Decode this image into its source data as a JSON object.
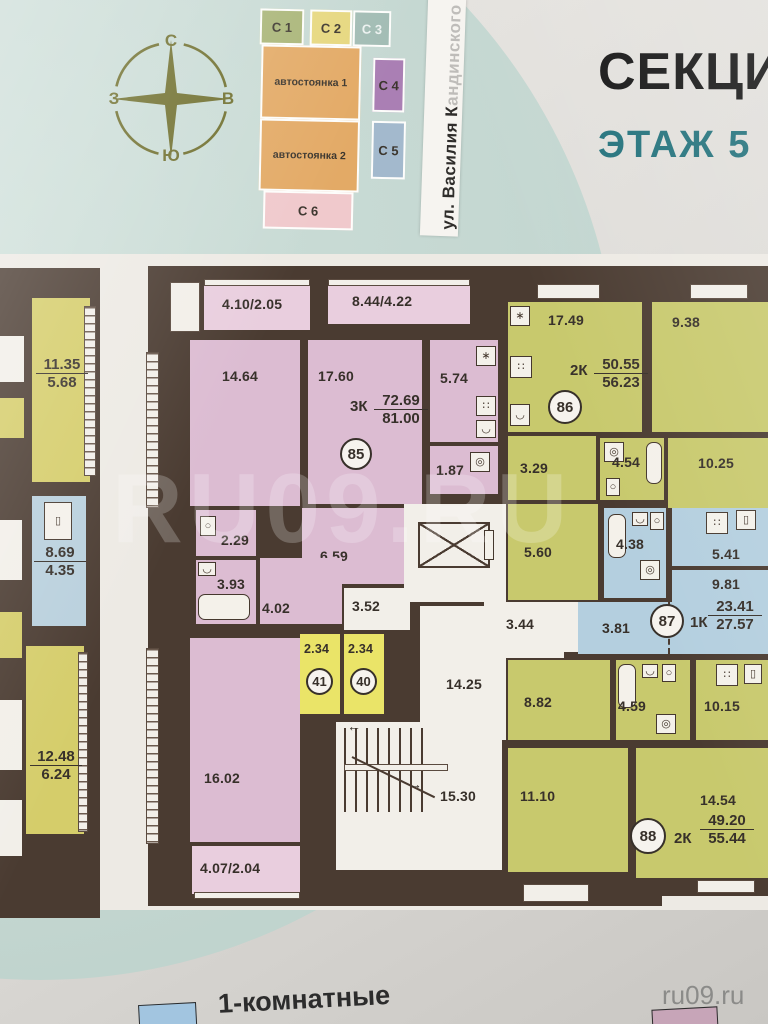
{
  "header": {
    "title": "СЕКЦИЯ",
    "floor_label": "ЭТАЖ 5"
  },
  "street": {
    "visible": "ул. Василия К",
    "faded": "андинского"
  },
  "compass": {
    "n": "С",
    "e": "В",
    "s": "Ю",
    "w": "З"
  },
  "site_map": {
    "c1": "С 1",
    "c2": "С 2",
    "c3": "С 3",
    "c4": "С 4",
    "c5": "С 5",
    "c6": "С 6",
    "parking1": "автостоянка 1",
    "parking2": "автостоянка 2"
  },
  "apartments": {
    "a85": {
      "no": "85",
      "type": "3К",
      "living": "72.69",
      "total": "81.00",
      "balcony_left": "4.10/2.05",
      "balcony_right": "8.44/4.22",
      "balcony_bottom": "4.07/2.04",
      "room1": "14.64",
      "room2": "17.60",
      "kitchen": "5.74",
      "bath_wc": "1.87",
      "wc": "2.29",
      "bath": "3.93",
      "hall": "4.02",
      "corridor": "6.59",
      "room3": "16.02"
    },
    "a86": {
      "no": "86",
      "type": "2К",
      "living": "50.55",
      "total": "56.23",
      "room1": "17.49",
      "room2": "9.38",
      "hall": "3.29",
      "bath": "4.54",
      "kitchen": "10.25",
      "hall2": "5.60"
    },
    "a87": {
      "no": "87",
      "type": "1К",
      "living": "23.41",
      "total": "27.57",
      "bath": "4.38",
      "kitchen": "5.41",
      "room": "9.81",
      "hall": "3.81"
    },
    "a88": {
      "no": "88",
      "type": "2К",
      "living": "49.20",
      "total": "55.44",
      "hall": "8.82",
      "bath": "4.59",
      "kitchen": "10.15",
      "room1": "11.10",
      "room2": "14.54"
    }
  },
  "storage": {
    "s41_no": "41",
    "s41_area": "2.34",
    "s40_no": "40",
    "s40_area": "2.34"
  },
  "common": {
    "hall_small": "3.52",
    "corridor": "14.25",
    "hall": "3.44",
    "stairs": "15.30"
  },
  "adjacent": {
    "apt_a_living": "11.35",
    "apt_a_half": "5.68",
    "apt_b_living": "8.69",
    "apt_b_half": "4.35",
    "apt_c_living": "12.48",
    "apt_c_half": "6.24"
  },
  "legend": {
    "one_room": "1-комнатные"
  },
  "watermark": {
    "corner": "ru09.ru",
    "overlay": "RU09.RU"
  },
  "icons": {
    "stove": "∷",
    "washer": "◎",
    "sink": "◡",
    "toilet": "○",
    "appliance": "▯",
    "vent": "∗"
  },
  "colors": {
    "walls": "#4a3b31",
    "three_room": "#dcbcd2",
    "two_room": "#c8c96d",
    "one_room": "#b4cfdf",
    "storage": "#eae468",
    "teal_bg": "#c4d7d1",
    "parking": "#e3aa66",
    "title_accent": "#20707a",
    "legend_one_room": "#a2c5e0"
  }
}
